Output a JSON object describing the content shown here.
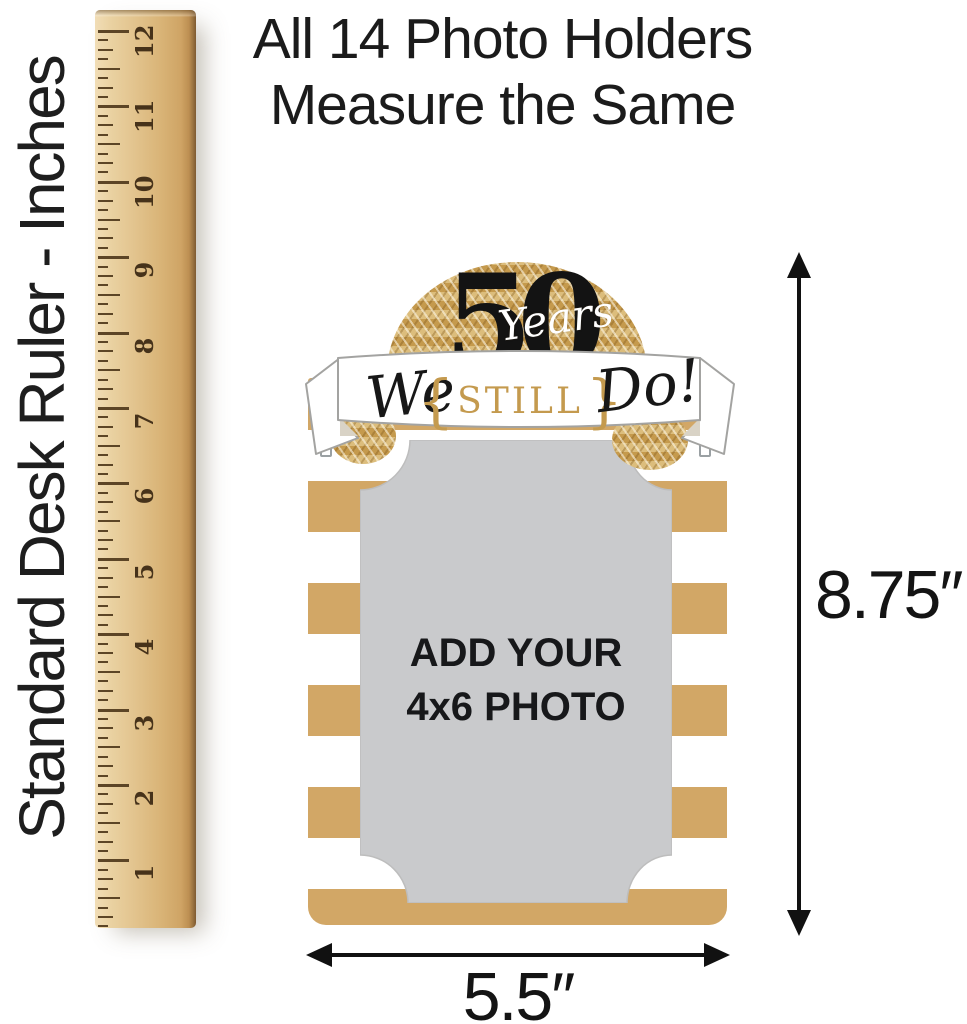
{
  "headline": {
    "line1": "All 14 Photo Holders",
    "line2": "Measure the Same"
  },
  "ruler": {
    "label": "Standard Desk Ruler - Inches",
    "numbers": [
      12,
      11,
      10,
      9,
      8,
      7,
      6,
      5,
      4,
      3,
      2,
      1
    ]
  },
  "photo_holder": {
    "anniversary_number": "50",
    "anniversary_script": "Years",
    "banner": {
      "left_word": "We",
      "open_brace": "{",
      "center_word": "STILL",
      "close_brace": "}",
      "right_word": "Do!"
    },
    "photo_placeholder": {
      "line1": "ADD YOUR",
      "line2": "4x6 PHOTO"
    }
  },
  "dimensions": {
    "height": "8.75″",
    "width": "5.5″"
  },
  "colors": {
    "gold_stripe": "#d2a766",
    "glitter_gold": "#cda55c",
    "photo_gray": "#c9cacc",
    "banner_gold_text": "#c49a4e",
    "text_black": "#1b1b1b",
    "wood_light": "#ead2a2",
    "wood_dark": "#9a7340"
  }
}
